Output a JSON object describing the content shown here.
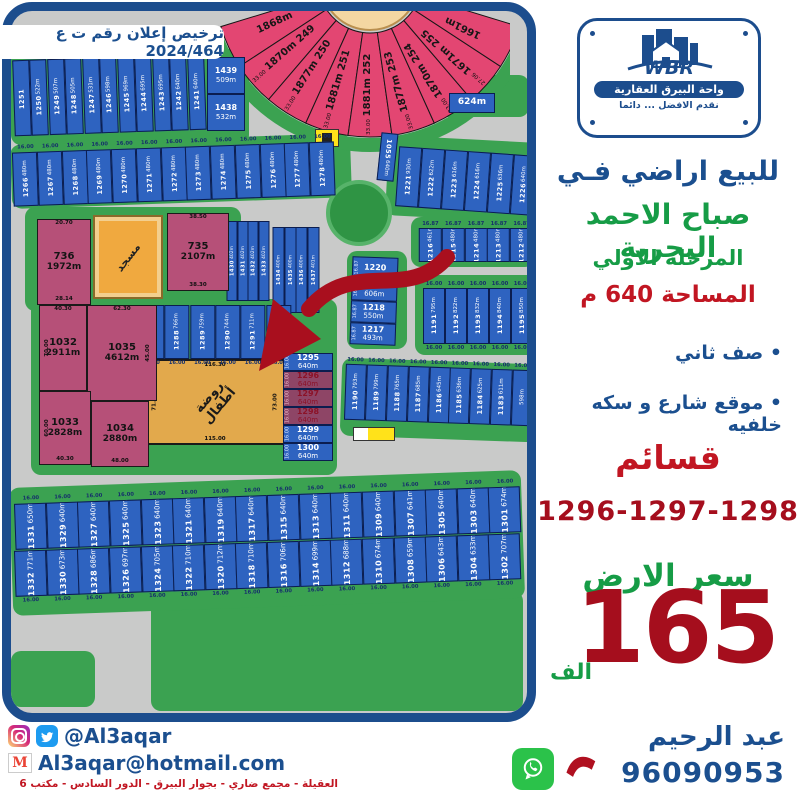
{
  "license_text": "ترخيص إعلان رقم ت ع 2024/464",
  "logo": {
    "brand": "WBR",
    "company": "واحة البيرق العقارية",
    "tagline": "نقدم الافضل ... دائما"
  },
  "panel": {
    "headline": "للبيع اراضي فـي",
    "location": "صباح الاحمد البحرية",
    "phase": "المرحلة الاولي",
    "area_line": "المساحة 640 م",
    "bullet1": "• صف ثاني",
    "bullet2": "• موقع شارع و سكه خلفيه",
    "plots_word": "قسائم",
    "plot_numbers": "1296-1297-1298",
    "price_label": "سعر الارض",
    "price_value": "165",
    "price_unit": "الف"
  },
  "footer": {
    "handle": "@Al3aqar",
    "email": "Al3aqar@hotmail.com",
    "address": "العقيلة - مجمع ضاري - بجوار البيرق - الدور السادس - مكتب 6",
    "agent_name": "عبد الرحيم",
    "phone": "96090953"
  },
  "colors": {
    "navy": "#1b4f8f",
    "green": "#169c46",
    "red": "#c11622",
    "dark_red": "#a50e1d",
    "plot_blue": "#2e63c0",
    "plot_pink": "#b65078",
    "fan_pink": "#e34672",
    "highlight": "#8e4566",
    "grass": "#3ba251",
    "road": "#c9cac9",
    "orange": "#f0a93f"
  },
  "map": {
    "mosque_label": "مسجد",
    "kindergarten": {
      "label": "روضة\nأطفال",
      "top": "116.30",
      "bottom": "115.00",
      "left": "71.00",
      "right": "73.00"
    },
    "dim16": "16.00",
    "dim1687": "16.87",
    "fan": [
      {
        "n": "",
        "a": "1868m",
        "d": ""
      },
      {
        "n": "249",
        "a": "1870m",
        "d": "33.00"
      },
      {
        "n": "250",
        "a": "1877m",
        "d": "33.00"
      },
      {
        "n": "251",
        "a": "1881m",
        "d": "33.00"
      },
      {
        "n": "252",
        "a": "1881m",
        "d": "33.00"
      },
      {
        "n": "253",
        "a": "1877m",
        "d": "33.00"
      },
      {
        "n": "254",
        "a": "1870m",
        "d": "33.00"
      },
      {
        "n": "255",
        "a": "1671m",
        "d": "27.06"
      },
      {
        "n": "",
        "a": "1661m",
        "d": ""
      }
    ],
    "row_top": [
      {
        "n": "1251",
        "a": ""
      },
      {
        "n": "1250",
        "a": "522m"
      },
      {
        "n": "1249",
        "a": "507m"
      },
      {
        "n": "1248",
        "a": "505m"
      },
      {
        "n": "1247",
        "a": "531m"
      },
      {
        "n": "1246",
        "a": "598m"
      },
      {
        "n": "1245",
        "a": "969m"
      },
      {
        "n": "1244",
        "a": "695m"
      },
      {
        "n": "1243",
        "a": "695m"
      },
      {
        "n": "1242",
        "a": "640m"
      },
      {
        "n": "1241",
        "a": "640m"
      }
    ],
    "corner_pair": [
      {
        "n": "1439",
        "a": "509m"
      },
      {
        "n": "1438",
        "a": "532m"
      }
    ],
    "plot_624": {
      "n": "",
      "a": "624m"
    },
    "row_1266": [
      {
        "n": "1266",
        "a": "480m"
      },
      {
        "n": "1267",
        "a": "480m"
      },
      {
        "n": "1268",
        "a": "480m"
      },
      {
        "n": "1269",
        "a": "480m"
      },
      {
        "n": "1270",
        "a": "480m"
      },
      {
        "n": "1271",
        "a": "480m"
      },
      {
        "n": "1272",
        "a": "480m"
      },
      {
        "n": "1273",
        "a": "480m"
      },
      {
        "n": "1274",
        "a": "480m"
      },
      {
        "n": "1275",
        "a": "480m"
      },
      {
        "n": "1276",
        "a": "480m"
      },
      {
        "n": "1277",
        "a": "480m"
      },
      {
        "n": "1278",
        "a": "480m"
      }
    ],
    "row_1222": [
      {
        "n": "1221",
        "a": "930m"
      },
      {
        "n": "1222",
        "a": "622m"
      },
      {
        "n": "1223",
        "a": "616m"
      },
      {
        "n": "1224",
        "a": "616m"
      },
      {
        "n": "1225",
        "a": "636m"
      },
      {
        "n": "1226",
        "a": "640m"
      }
    ],
    "plot_1055": {
      "n": "1055",
      "a": "640m"
    },
    "col_1430": [
      {
        "n": "1430",
        "a": "402m"
      },
      {
        "n": "1431",
        "a": "402m"
      },
      {
        "n": "1432",
        "a": "402m"
      },
      {
        "n": "1433",
        "a": "402m"
      }
    ],
    "col_1434": [
      {
        "n": "1434",
        "a": "400m"
      },
      {
        "n": "1435",
        "a": "400m"
      },
      {
        "n": "1436",
        "a": "400m"
      },
      {
        "n": "1437",
        "a": "401m"
      }
    ],
    "plot_736": {
      "n": "736",
      "a": "1972m",
      "d1": "20.70",
      "d2": "28.14"
    },
    "plot_735": {
      "n": "735",
      "a": "2107m",
      "d1": "38.50",
      "d2": "38.30"
    },
    "row_1287": [
      {
        "n": "1287",
        "a": "761m"
      },
      {
        "n": "1288",
        "a": "766m"
      },
      {
        "n": "1289",
        "a": "759m"
      },
      {
        "n": "1290",
        "a": "744m"
      },
      {
        "n": "1291",
        "a": "711m"
      },
      {
        "n": "1292",
        "a": "699m"
      }
    ],
    "big_plots": [
      {
        "n": "1032",
        "a": "2911m",
        "dt": "40.30",
        "dl": "70.00"
      },
      {
        "n": "1035",
        "a": "4612m",
        "dt": "62.30",
        "dr": "45.00"
      },
      {
        "n": "1033",
        "a": "2828m",
        "dl": "60.00",
        "db": "40.30"
      },
      {
        "n": "1034",
        "a": "2880m",
        "db": "48.00"
      }
    ],
    "col_hl": [
      {
        "n": "1295",
        "a": "640m",
        "hl": false
      },
      {
        "n": "1296",
        "a": "640m",
        "hl": true
      },
      {
        "n": "1297",
        "a": "640m",
        "hl": true
      },
      {
        "n": "1298",
        "a": "640m",
        "hl": true
      },
      {
        "n": "1299",
        "a": "640m",
        "hl": false
      },
      {
        "n": "1300",
        "a": "640m",
        "hl": false
      }
    ],
    "col_1217": [
      {
        "n": "1220",
        "a": ""
      },
      {
        "n": "1219",
        "a": "606m"
      },
      {
        "n": "1218",
        "a": "550m"
      },
      {
        "n": "1217",
        "a": "493m"
      }
    ],
    "row_1212": [
      {
        "n": "1216",
        "a": "461m"
      },
      {
        "n": "1215",
        "a": "480m"
      },
      {
        "n": "1214",
        "a": "480m"
      },
      {
        "n": "1213",
        "a": "480m"
      },
      {
        "n": "1212",
        "a": "480m"
      }
    ],
    "row_1191": [
      {
        "n": "1191",
        "a": "795m"
      },
      {
        "n": "1192",
        "a": "822m"
      },
      {
        "n": "1193",
        "a": "832m"
      },
      {
        "n": "1194",
        "a": "840m"
      },
      {
        "n": "1195",
        "a": "850m"
      }
    ],
    "row_1190": [
      {
        "n": "1190",
        "a": "793m"
      },
      {
        "n": "1189",
        "a": "799m"
      },
      {
        "n": "1188",
        "a": "765m"
      },
      {
        "n": "1187",
        "a": "685m"
      },
      {
        "n": "1186",
        "a": "645m"
      },
      {
        "n": "1185",
        "a": "636m"
      },
      {
        "n": "1184",
        "a": "625m"
      },
      {
        "n": "1183",
        "a": "611m"
      },
      {
        "n": "",
        "a": "598m"
      }
    ],
    "row_b1": [
      {
        "n": "1331",
        "a": "650m"
      },
      {
        "n": "1329",
        "a": "640m"
      },
      {
        "n": "1327",
        "a": "640m"
      },
      {
        "n": "1325",
        "a": "640m"
      },
      {
        "n": "1323",
        "a": "640m"
      },
      {
        "n": "1321",
        "a": "640m"
      },
      {
        "n": "1319",
        "a": "640m"
      },
      {
        "n": "1317",
        "a": "640m"
      },
      {
        "n": "1315",
        "a": "640m"
      },
      {
        "n": "1313",
        "a": "640m"
      },
      {
        "n": "1311",
        "a": "640m"
      },
      {
        "n": "1309",
        "a": "640m"
      },
      {
        "n": "1307",
        "a": "641m"
      },
      {
        "n": "1305",
        "a": "640m"
      },
      {
        "n": "1303",
        "a": "640m"
      },
      {
        "n": "1301",
        "a": "674m"
      }
    ],
    "row_b2": [
      {
        "n": "1332",
        "a": "771m"
      },
      {
        "n": "1330",
        "a": "673m"
      },
      {
        "n": "1328",
        "a": "686m"
      },
      {
        "n": "1326",
        "a": "697m"
      },
      {
        "n": "1324",
        "a": "705m"
      },
      {
        "n": "1322",
        "a": "710m"
      },
      {
        "n": "1320",
        "a": "712m"
      },
      {
        "n": "1318",
        "a": "710m"
      },
      {
        "n": "1316",
        "a": "706m"
      },
      {
        "n": "1314",
        "a": "699m"
      },
      {
        "n": "1312",
        "a": "688m"
      },
      {
        "n": "1310",
        "a": "674m"
      },
      {
        "n": "1308",
        "a": "659m"
      },
      {
        "n": "1306",
        "a": "643m"
      },
      {
        "n": "1304",
        "a": "633m"
      },
      {
        "n": "1302",
        "a": "707m"
      }
    ]
  }
}
